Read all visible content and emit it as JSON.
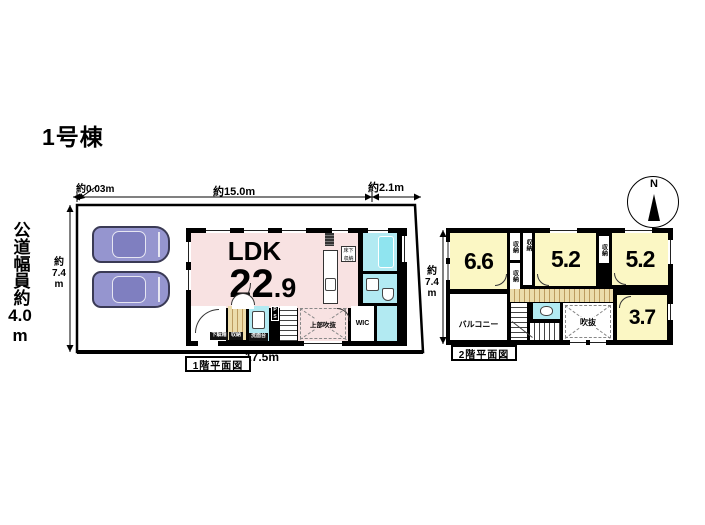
{
  "title": "1号棟",
  "road": {
    "text": "公道幅員約",
    "value": "4.0",
    "unit": "m"
  },
  "compass": {
    "north": "N"
  },
  "dims": {
    "top_offset": "約0.03m",
    "top_main": "約15.0m",
    "top_right": "約2.1m",
    "side_left": {
      "prefix": "約",
      "value": "7.4",
      "unit": "m"
    },
    "side_right": {
      "prefix": "約",
      "value": "7.4",
      "unit": "m"
    },
    "bottom": "17.5m"
  },
  "floor1": {
    "caption": "1階平面図",
    "ldk_label": "LDK",
    "ldk_size_int": "22",
    "ldk_size_dec": ".9",
    "floor_storage": "床下収納",
    "shoe_cabinet": "下駄箱",
    "storage": "収納",
    "vanity": "洗面台",
    "pipe_space": "PS",
    "open_above": "上部吹抜",
    "wic": "WIC"
  },
  "floor2": {
    "caption": "2階平面図",
    "rooms": [
      {
        "size": "6.6"
      },
      {
        "size": "5.2"
      },
      {
        "size": "5.2"
      },
      {
        "size": "3.7"
      }
    ],
    "storage": "収納",
    "balcony": "バルコニー",
    "void": "吹抜"
  },
  "icons": {
    "north_arrow": "black-triangle-up",
    "bathtub": "rounded-rect",
    "toilet": "rounded-rect",
    "sink": "square",
    "stove": "hatched-square",
    "car": "top-view-car"
  },
  "colors": {
    "room_pink": "#f8e2e2",
    "room_yellow": "#fbf7c4",
    "water_cyan": "#b2eaf2",
    "tub_cyan": "#8fe4ef",
    "car_body": "#9595cf",
    "car_cabin": "#7f7fc0",
    "stair_tan": "#ecdcab",
    "stair_tan_dark": "#bd9c60",
    "wall": "#000000"
  }
}
